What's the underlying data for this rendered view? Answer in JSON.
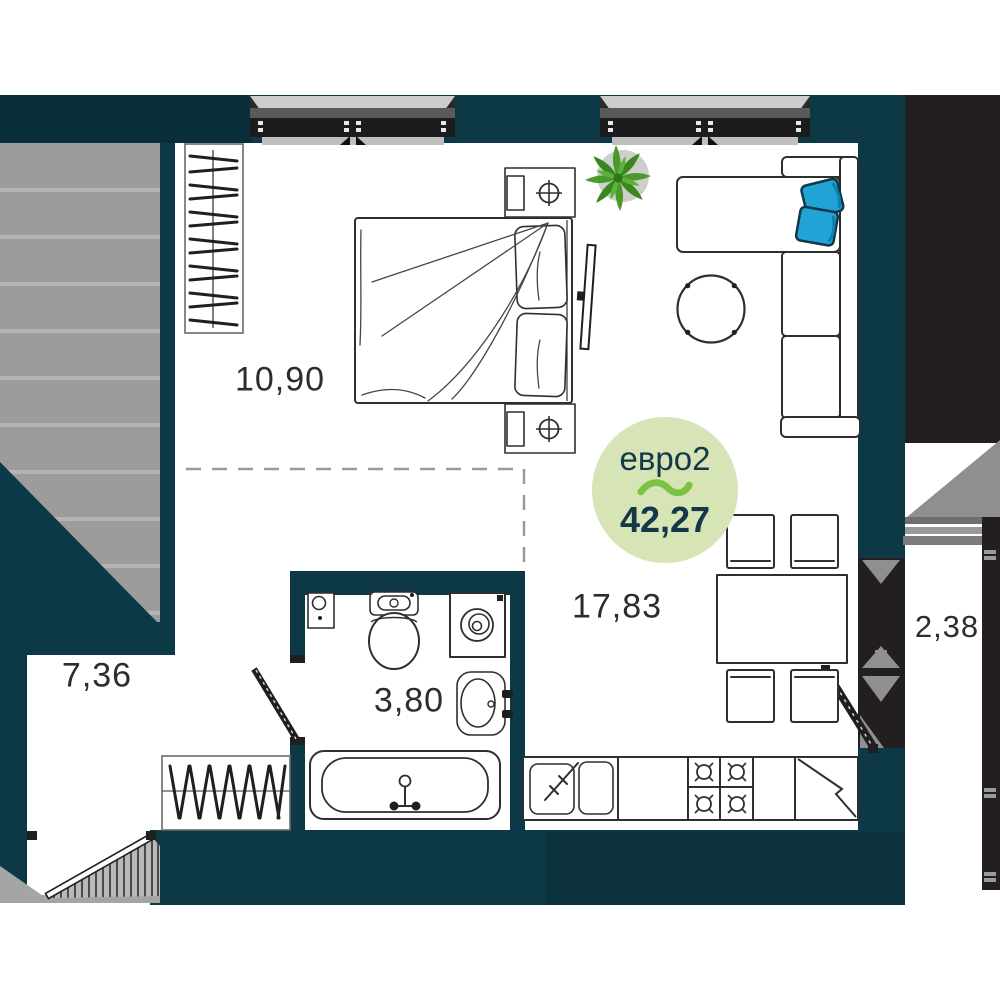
{
  "plan": {
    "badge": {
      "layout_label": "евро2",
      "total_area": "42,27"
    },
    "areas": {
      "bedroom": "10,90",
      "kitchen_living": "17,83",
      "bathroom": "3,80",
      "hallway": "7,36",
      "loggia": "2,38"
    },
    "colors": {
      "wall": "#0d3846",
      "neighbor_gray": "#9c9c9c",
      "block_black": "#231f20",
      "badge_bg": "#d6e4b6",
      "badge_text": "#14384a",
      "accent_green": "#7cc141",
      "pillow_blue": "#21a3d6",
      "plant_green": "#4a9929",
      "label_text": "#2d2d2d"
    },
    "furniture_icons": [
      "wardrobe-icon",
      "double-bed-icon",
      "nightstand-icon",
      "tv-icon",
      "plant-icon",
      "sofa-icon",
      "pillow-icon",
      "coffee-table-icon",
      "dining-table-icon",
      "chair-icon",
      "kitchen-sink-icon",
      "stove-icon",
      "fridge-icon",
      "toilet-icon",
      "washing-machine-icon",
      "bathroom-sink-icon",
      "bathtub-icon",
      "shoe-rack-icon",
      "window-icon",
      "door-icon"
    ]
  }
}
